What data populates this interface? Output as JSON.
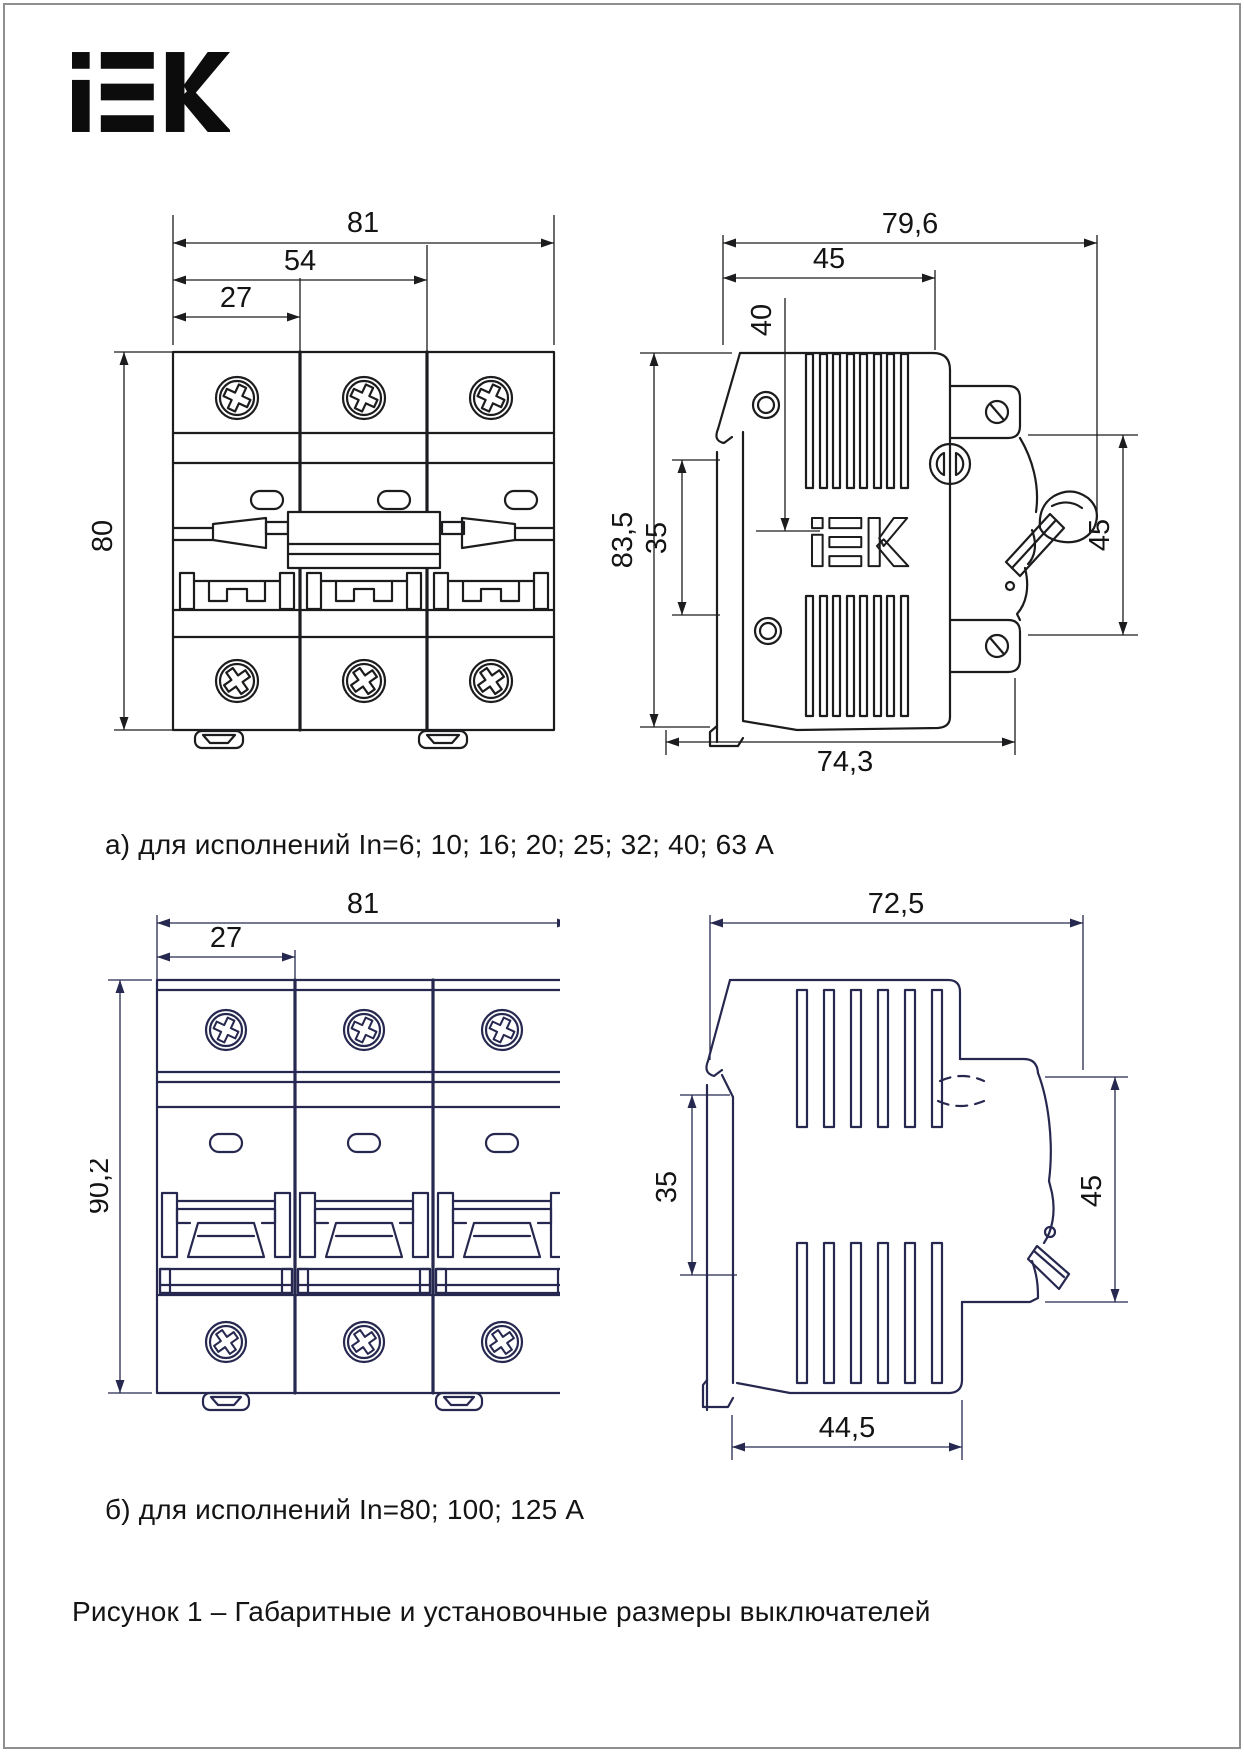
{
  "page": {
    "brand": "IEK",
    "figure_caption": "Рисунок 1 – Габаритные и установочные размеры выключателей"
  },
  "drawing_a": {
    "caption": "а) для исполнений In=6; 10; 16; 20; 25; 32; 40; 63 А",
    "front": {
      "width_total_mm": "81",
      "width_two_poles_mm": "54",
      "pole_width_mm": "27",
      "height_mm": "80"
    },
    "side": {
      "depth_total_mm": "79,6",
      "depth_top_mm": "45",
      "handle_offset_mm": "40",
      "height_mm": "83,5",
      "din_window_mm": "35",
      "front_height_mm": "45",
      "depth_bottom_mm": "74,3",
      "embossed_logo": "IEK"
    }
  },
  "drawing_b": {
    "caption": "б) для исполнений In=80; 100; 125 А",
    "front": {
      "width_total_mm": "81",
      "pole_width_mm": "27",
      "height_mm": "90,2"
    },
    "side": {
      "depth_total_mm": "72,5",
      "din_window_mm": "35",
      "front_height_mm": "45",
      "depth_bottom_mm": "44,5"
    }
  },
  "colors": {
    "line_dark": "#1c1c1e",
    "line_navy": "#26284f",
    "text": "#141414",
    "frame": "#8f8f8f",
    "background": "#ffffff"
  }
}
